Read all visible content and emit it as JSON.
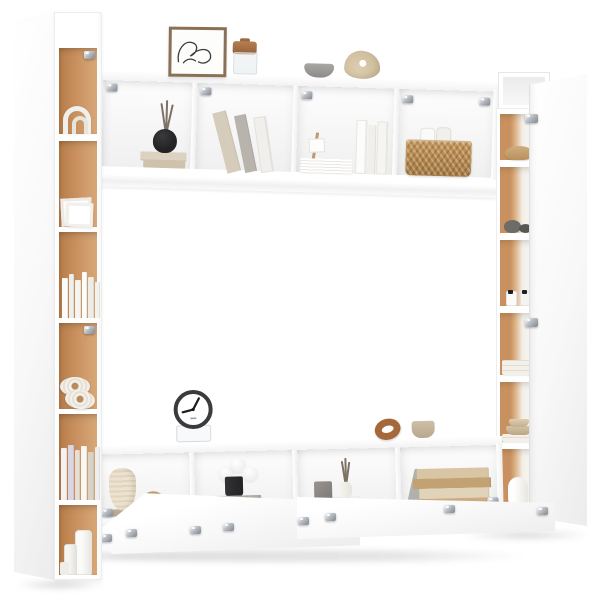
{
  "meta": {
    "description": "Product photo of a white wall-mounted living room furniture set: a tall narrow bookcase on the left, a four-compartment wall shelf on top, a tall cabinet with door on the right, and a TV stand with open flip-down doors at the bottom, decorated with books, vases, baskets and ornaments on a plain white background"
  },
  "palette": {
    "bg": "#ffffff",
    "panel-shade": "#ececec",
    "panel-edge": "#e4e4e4",
    "oak": "#c9915f",
    "oak-light": "#d8a878",
    "oak-dark": "#b67c49",
    "metal": "#b8bdc3",
    "metal-dark": "#8f959c",
    "wicker": "#c79757",
    "wicker-dark": "#a6793f",
    "black-item": "#232325",
    "clock-rim": "#3b3b3d",
    "cream": "#e8ddc6",
    "wood": "#a5683a",
    "wood-light": "#bd9a6f",
    "frame": "#8a7156",
    "line": "#3c3c3c",
    "board": "#b3a492",
    "crate": "#a8a29a",
    "beige": "#d9c5a4",
    "tan": "#c2a173",
    "ivory": "#f2efe8",
    "lavender": "#dcd5e2",
    "gray": "#8e8c89",
    "stone": "#6e6c69"
  },
  "scene": {
    "left_bookcase": {
      "name": "tall narrow bookcase with oak back panels and side door",
      "shelf_items": [
        "white arch ornament",
        "white picture frames",
        "row of white books",
        "two rope coil discs",
        "row of pastel books",
        "white cylinder vases"
      ]
    },
    "top_shelf": {
      "name": "wall-mounted shelf unit with four compartments",
      "top_items": [
        "framed abstract line-art print",
        "glass jar with cork lid",
        "gray bowl",
        "beige sculptural vase"
      ],
      "compartment_items": [
        "black reed diffuser on stacked beige books",
        "leaning books",
        "paper stack, mini wooden easel and standing white books",
        "wicker basket with rolled papers"
      ]
    },
    "right_cabinet": {
      "name": "tall cabinet with open oak-backed shelves and white door",
      "shelf_items": [
        "straw hat",
        "gray stones",
        "small bottles with black caps",
        "folded white towels",
        "beige bowls on towels",
        "white vase"
      ]
    },
    "tv_stand": {
      "name": "wall-mounted TV stand with open flip-down doors",
      "top_items": [
        "round alarm clock on acrylic stand",
        "wooden knot ornament",
        "beige ceramic cup"
      ],
      "compartment_items": [
        "cream textured vase and knot ornament on wooden board",
        "black pot with white pompom flowers on gray wooden crate",
        "gray cube and white reed vase on white box",
        "stack of antique beige books with leaning gray book"
      ]
    },
    "hardware": "silver metal hinges and wall brackets on shelf corners and doors",
    "shadows": "soft gray floor shadows beneath each unit"
  }
}
